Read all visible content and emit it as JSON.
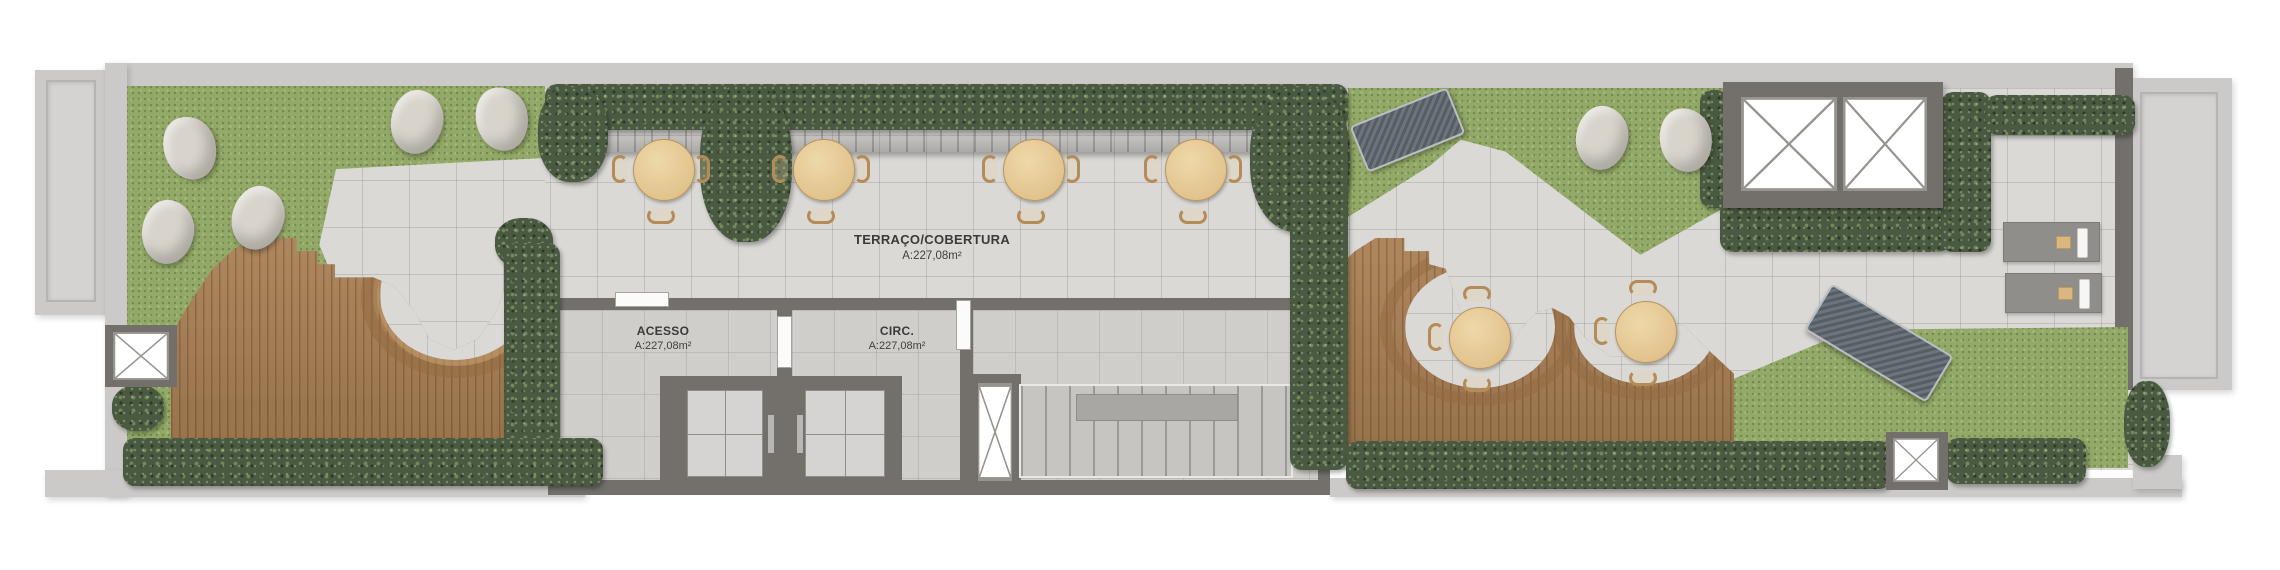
{
  "plan": {
    "type": "architectural-floor-plan",
    "view": "rooftop-terrace-top-view",
    "labels": {
      "terraco": {
        "name": "TERRAÇO/COBERTURA",
        "area": "A:227,08m²"
      },
      "acesso": {
        "name": "ACESSO",
        "area": "A:227,08m²"
      },
      "circ": {
        "name": "CIRC.",
        "area": "A:227,08m²"
      }
    },
    "colors": {
      "background": "#ffffff",
      "slab": "#cbcac8",
      "paving": "#dad9d6",
      "floor": "#cfcecb",
      "wall": "#73706b",
      "grass": "#93a967",
      "hedge": "#4a5a41",
      "deck": "#a87e52",
      "counter_wood": "#7d5a3c",
      "table_wood": "#e2c28c"
    },
    "furniture": {
      "dining_tables": 6,
      "dining_chairs": 18,
      "beanbag_lounge_chairs": 7,
      "hammocks": 2,
      "sun_loungers": 2,
      "elevators": 2,
      "stair_flights": 1,
      "roof_openings": 2,
      "shaft_openings": 3
    }
  }
}
